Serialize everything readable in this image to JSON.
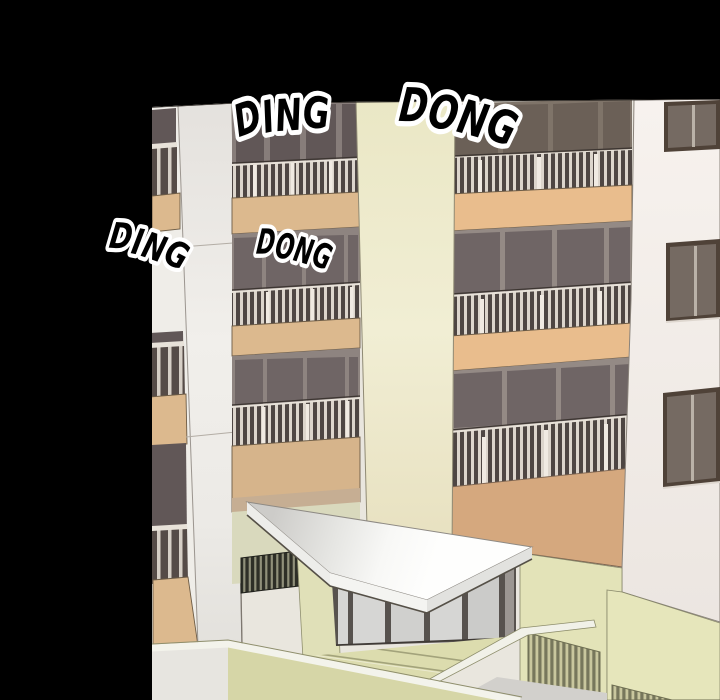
{
  "sfx": [
    "DING",
    "DONG",
    "DING",
    "DONG"
  ],
  "colors": {
    "background": "#000000",
    "sfx_text": "#000000",
    "sfx_outline": "#ffffff",
    "facade_frame": "#8e8480",
    "window_glass": "#6f6565",
    "balcony_tan": "#dcb98e",
    "balcony_tan_right": "#e9bd8d",
    "wall_orange": "#d5a87e",
    "wall_green": "#e3e3b8",
    "wall_white": "#f4efeb",
    "column_cream": "#eeebcd",
    "column_white": "#eeece8",
    "canopy": "#fbfbfa",
    "steps": "#dcdcae",
    "glass_door": "#d6d6d4",
    "railing_bar": "#dcd5cc",
    "railing_dark": "#4e4643"
  }
}
